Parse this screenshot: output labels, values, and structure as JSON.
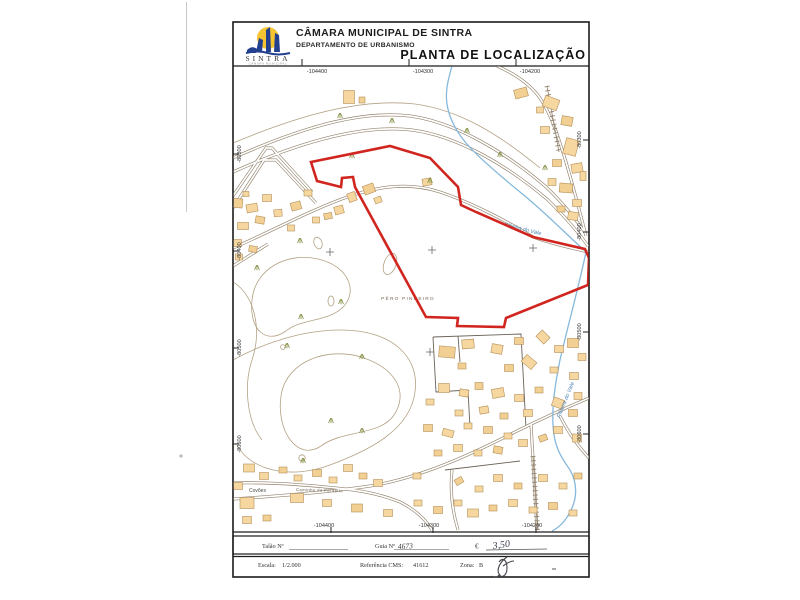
{
  "header": {
    "municipality": "CÂMARA MUNICIPAL DE SINTRA",
    "department": "DEPARTAMENTO DE URBANISMO",
    "title": "PLANTA DE LOCALIZAÇÃO",
    "logo": {
      "name": "SINTRA",
      "subtext": "CÂMARA MUNICIPAL"
    }
  },
  "map": {
    "grid": {
      "top": [
        "-104400",
        "-104300",
        "-104200"
      ],
      "bottom": [
        "-104400",
        "-104300",
        "-104200"
      ],
      "left": [
        "-80300",
        "-80400",
        "-80500",
        "-80600"
      ],
      "right": [
        "-80300",
        "-80400",
        "-80500",
        "-80600"
      ]
    },
    "labels": {
      "place": "PÊRO PINHEIRO",
      "hamlet": "Covões",
      "stream1": "Ribeira do Vale",
      "stream2": "Ribeira do Vale",
      "road": "Caminho do Perapito"
    },
    "colors": {
      "parcel": "#d1251f",
      "building_fill": "#f6d7a0",
      "building_stroke": "#b5905a",
      "road": "#93836d",
      "contour": "#b3a184",
      "stream": "#85b8dc"
    },
    "buildings": [
      [
        521,
        93,
        13,
        9,
        -15
      ],
      [
        551,
        103,
        15,
        11,
        20
      ],
      [
        540,
        110,
        7,
        6,
        0
      ],
      [
        567,
        121,
        11,
        9,
        10
      ],
      [
        545,
        130,
        9,
        7,
        0
      ],
      [
        571,
        147,
        13,
        16,
        15
      ],
      [
        557,
        163,
        9,
        7,
        0
      ],
      [
        577,
        168,
        11,
        9,
        -10
      ],
      [
        552,
        182,
        8,
        7,
        0
      ],
      [
        566,
        188,
        13,
        9,
        5
      ],
      [
        583,
        176,
        6,
        9,
        0
      ],
      [
        577,
        203,
        9,
        7,
        0
      ],
      [
        561,
        209,
        8,
        6,
        0
      ],
      [
        573,
        216,
        10,
        8,
        10
      ],
      [
        349,
        97,
        11,
        13,
        0
      ],
      [
        362,
        100,
        6,
        6,
        0
      ],
      [
        339,
        210,
        9,
        8,
        -15
      ],
      [
        352,
        197,
        8,
        9,
        -20
      ],
      [
        369,
        189,
        11,
        9,
        -20
      ],
      [
        378,
        200,
        7,
        6,
        -20
      ],
      [
        427,
        182,
        9,
        7,
        -10
      ],
      [
        236,
        203,
        13,
        9,
        5
      ],
      [
        252,
        208,
        11,
        8,
        -10
      ],
      [
        267,
        198,
        9,
        7,
        0
      ],
      [
        260,
        220,
        9,
        7,
        10
      ],
      [
        243,
        226,
        11,
        7,
        0
      ],
      [
        278,
        213,
        8,
        7,
        -5
      ],
      [
        296,
        206,
        10,
        8,
        -15
      ],
      [
        308,
        193,
        8,
        6,
        0
      ],
      [
        316,
        220,
        7,
        6,
        0
      ],
      [
        328,
        216,
        8,
        6,
        -10
      ],
      [
        291,
        228,
        7,
        6,
        0
      ],
      [
        237,
        243,
        9,
        7,
        0
      ],
      [
        253,
        249,
        8,
        6,
        10
      ],
      [
        239,
        257,
        7,
        6,
        0
      ],
      [
        246,
        194,
        6,
        5,
        0
      ],
      [
        447,
        352,
        16,
        11,
        5
      ],
      [
        468,
        344,
        12,
        9,
        -5
      ],
      [
        497,
        349,
        11,
        9,
        10
      ],
      [
        519,
        341,
        9,
        7,
        0
      ],
      [
        543,
        337,
        11,
        9,
        45
      ],
      [
        559,
        349,
        9,
        7,
        0
      ],
      [
        573,
        343,
        11,
        9,
        0
      ],
      [
        582,
        357,
        8,
        7,
        0
      ],
      [
        529,
        362,
        13,
        9,
        40
      ],
      [
        509,
        368,
        9,
        7,
        0
      ],
      [
        554,
        370,
        8,
        6,
        0
      ],
      [
        574,
        376,
        9,
        7,
        0
      ],
      [
        462,
        366,
        8,
        6,
        0
      ],
      [
        444,
        388,
        11,
        9,
        0
      ],
      [
        464,
        393,
        9,
        7,
        10
      ],
      [
        479,
        386,
        8,
        7,
        0
      ],
      [
        498,
        393,
        12,
        9,
        -10
      ],
      [
        519,
        398,
        9,
        7,
        0
      ],
      [
        539,
        390,
        8,
        6,
        0
      ],
      [
        558,
        403,
        11,
        9,
        20
      ],
      [
        578,
        396,
        8,
        7,
        0
      ],
      [
        573,
        413,
        9,
        7,
        0
      ],
      [
        459,
        413,
        8,
        6,
        0
      ],
      [
        484,
        410,
        9,
        7,
        -10
      ],
      [
        504,
        416,
        8,
        6,
        0
      ],
      [
        528,
        413,
        9,
        7,
        0
      ],
      [
        430,
        402,
        8,
        6,
        0
      ],
      [
        428,
        428,
        9,
        7,
        0
      ],
      [
        448,
        433,
        11,
        7,
        15
      ],
      [
        468,
        426,
        8,
        6,
        0
      ],
      [
        488,
        430,
        9,
        7,
        0
      ],
      [
        508,
        436,
        8,
        6,
        0
      ],
      [
        523,
        443,
        9,
        7,
        0
      ],
      [
        543,
        438,
        8,
        6,
        -20
      ],
      [
        558,
        430,
        9,
        7,
        0
      ],
      [
        577,
        438,
        9,
        8,
        0
      ],
      [
        438,
        453,
        8,
        6,
        0
      ],
      [
        458,
        448,
        9,
        7,
        0
      ],
      [
        478,
        453,
        8,
        6,
        0
      ],
      [
        498,
        450,
        9,
        7,
        10
      ],
      [
        249,
        468,
        11,
        8,
        0
      ],
      [
        264,
        476,
        9,
        7,
        0
      ],
      [
        283,
        470,
        8,
        6,
        0
      ],
      [
        238,
        486,
        9,
        7,
        0
      ],
      [
        298,
        478,
        8,
        6,
        0
      ],
      [
        317,
        473,
        9,
        7,
        0
      ],
      [
        333,
        480,
        8,
        6,
        0
      ],
      [
        348,
        468,
        9,
        7,
        0
      ],
      [
        363,
        476,
        8,
        6,
        0
      ],
      [
        378,
        483,
        9,
        7,
        0
      ],
      [
        417,
        476,
        8,
        6,
        0
      ],
      [
        459,
        481,
        8,
        6,
        -30
      ],
      [
        479,
        489,
        8,
        6,
        0
      ],
      [
        498,
        478,
        9,
        7,
        0
      ],
      [
        518,
        486,
        8,
        6,
        0
      ],
      [
        543,
        478,
        9,
        7,
        0
      ],
      [
        563,
        486,
        8,
        6,
        0
      ],
      [
        578,
        476,
        8,
        6,
        0
      ],
      [
        297,
        498,
        13,
        9,
        0
      ],
      [
        327,
        503,
        9,
        7,
        0
      ],
      [
        357,
        508,
        11,
        8,
        0
      ],
      [
        388,
        513,
        9,
        7,
        0
      ],
      [
        418,
        503,
        8,
        6,
        0
      ],
      [
        438,
        510,
        9,
        7,
        0
      ],
      [
        458,
        503,
        8,
        6,
        0
      ],
      [
        473,
        513,
        11,
        8,
        0
      ],
      [
        493,
        508,
        8,
        6,
        0
      ],
      [
        513,
        503,
        9,
        7,
        0
      ],
      [
        533,
        510,
        8,
        6,
        0
      ],
      [
        553,
        506,
        9,
        7,
        0
      ],
      [
        573,
        513,
        8,
        6,
        0
      ],
      [
        247,
        503,
        14,
        11,
        0
      ],
      [
        267,
        518,
        8,
        6,
        0
      ],
      [
        247,
        520,
        9,
        7,
        0
      ]
    ],
    "tufts": [
      [
        300,
        241
      ],
      [
        257,
        268
      ],
      [
        341,
        302
      ],
      [
        362,
        357
      ],
      [
        301,
        317
      ],
      [
        430,
        181
      ],
      [
        352,
        156
      ],
      [
        392,
        121
      ],
      [
        340,
        116
      ],
      [
        467,
        131
      ],
      [
        287,
        346
      ],
      [
        331,
        421
      ],
      [
        362,
        431
      ],
      [
        303,
        461
      ],
      [
        500,
        155
      ],
      [
        545,
        168
      ]
    ],
    "crosses": [
      [
        330,
        252
      ],
      [
        432,
        250
      ],
      [
        533,
        248
      ],
      [
        430,
        352
      ]
    ]
  },
  "footer": {
    "talao_label": "Talão Nº",
    "guia_label": "Guia Nº",
    "guia_value": "4673",
    "currency": "€",
    "amount": "3,50",
    "scale_label": "Escala:",
    "scale_value": "1/2.000",
    "ref_label": "Referência CMS:",
    "ref_value": "41612",
    "zone_label": "Zona:",
    "zone_value": "B"
  }
}
